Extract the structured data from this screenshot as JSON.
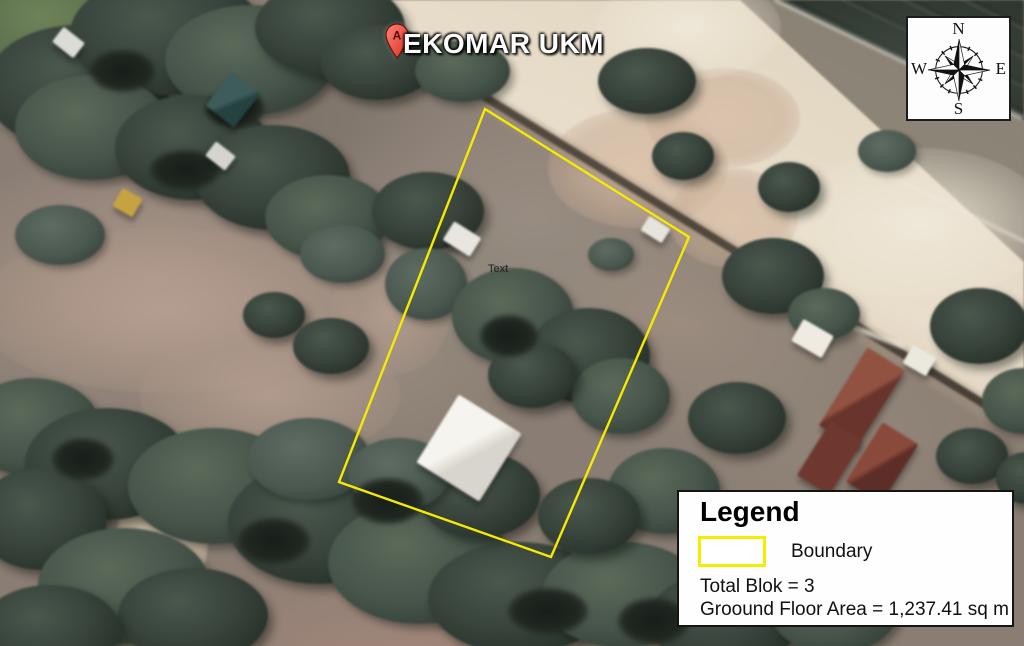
{
  "map": {
    "marker": {
      "letter": "A",
      "label": "EKOMAR UKM"
    },
    "site_label": "Text",
    "boundary_color": "#f6ea00"
  },
  "compass": {
    "n": "N",
    "e": "E",
    "s": "S",
    "w": "W"
  },
  "legend": {
    "title": "Legend",
    "boundary_item": {
      "label": "Boundary",
      "symbol": "yellow-rectangle-outline"
    },
    "total_blok": "Total Blok = 3",
    "ground_floor_area": "Groound Floor Area = 1,237.41 sq m"
  }
}
